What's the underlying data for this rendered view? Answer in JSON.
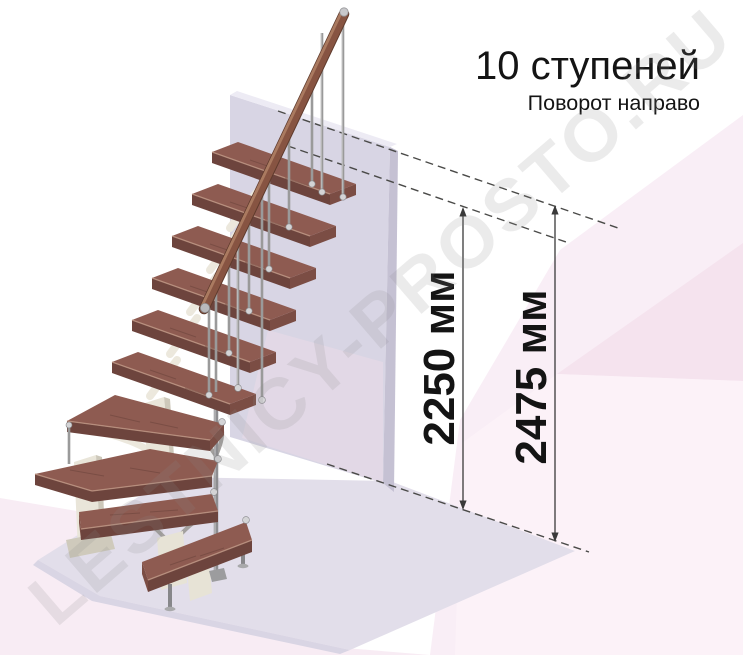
{
  "title": {
    "heading": "10 ступеней",
    "subtitle": "Поворот направо"
  },
  "dimensions": {
    "stair_height": "2250 мм",
    "total_height": "2475 мм"
  },
  "watermark": {
    "text": "LESTNICY-PROSTO.RU"
  },
  "stairs": {
    "step_count": 10,
    "turn_direction": "направо",
    "straight_upper_steps": 6,
    "winder_steps": 2,
    "lower_steps": 2
  },
  "colors": {
    "text": "#141414",
    "dimension": "#3a3a3a",
    "dashed": "#4a4a48",
    "wood_top": "#8e5b51",
    "wood_front": "#6d443d",
    "wood_end": "#7b4d44",
    "rail_wood": "#875442",
    "metal": "#9a9a9a",
    "support_cream": "#e9e5d9",
    "wall_front": "#d8d5e4",
    "wall_top": "#edebf4",
    "wall_side": "#c5c1d3",
    "floor_slab": "#e2deea",
    "pink_light": "#f9eef6",
    "pink_deep": "#f5e3ee",
    "pink_pale": "#fcf2f8",
    "pink_left": "#f8ecf4"
  }
}
